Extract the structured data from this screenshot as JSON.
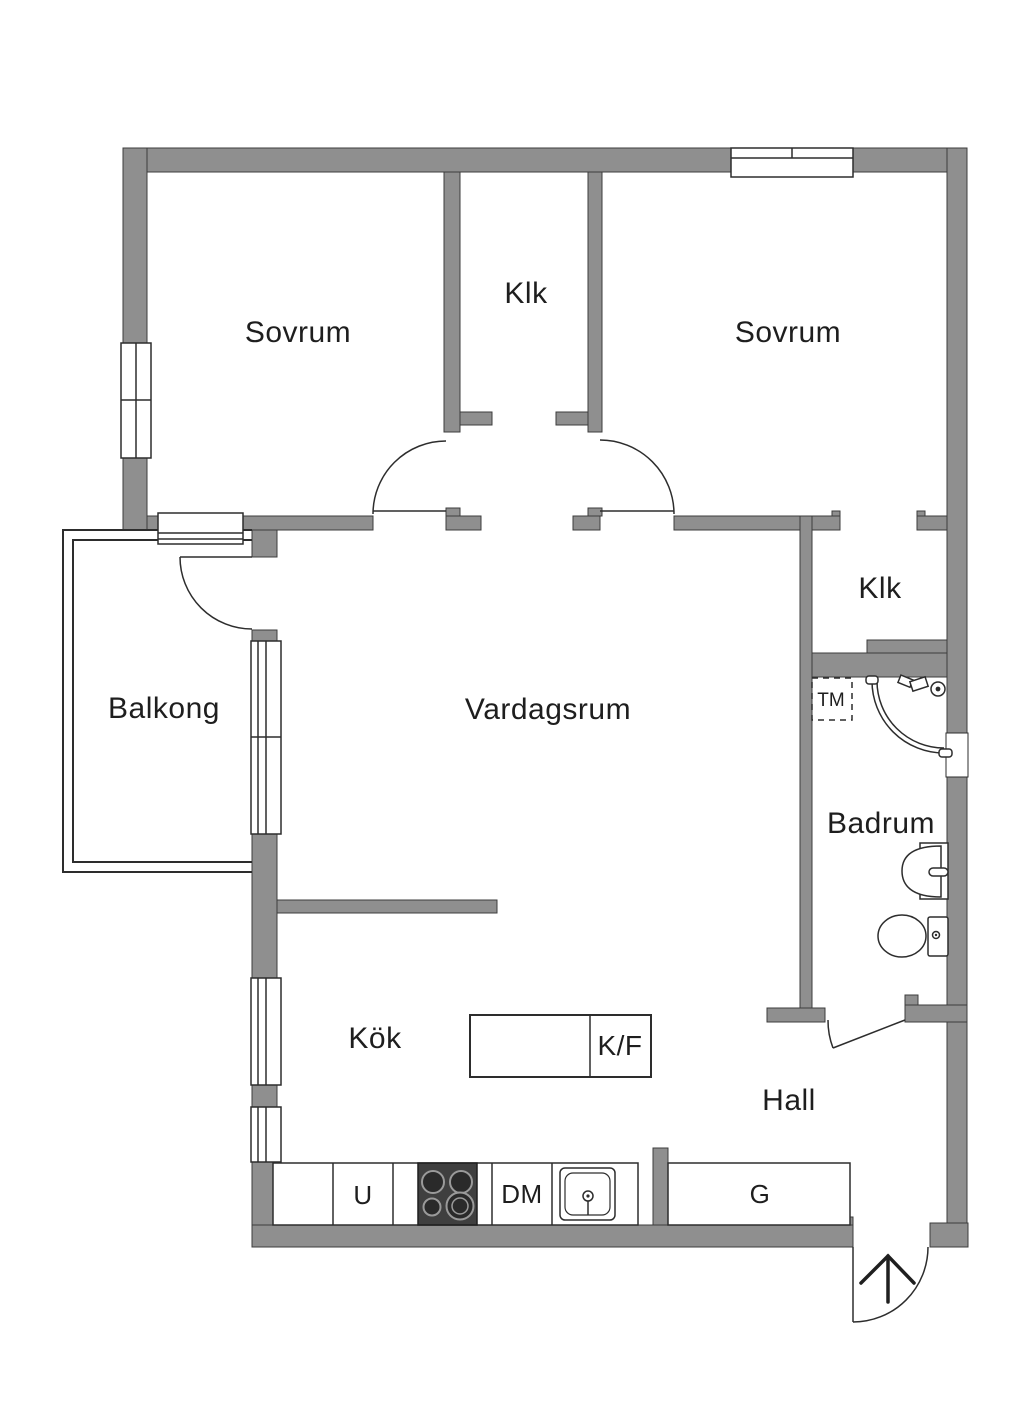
{
  "floorplan": {
    "rooms": {
      "bedroom_left": {
        "label": "Sovrum"
      },
      "closet_middle": {
        "label": "Klk"
      },
      "bedroom_right": {
        "label": "Sovrum"
      },
      "closet_right": {
        "label": "Klk"
      },
      "balcony": {
        "label": "Balkong"
      },
      "living_room": {
        "label": "Vardagsrum"
      },
      "bathroom": {
        "label": "Badrum"
      },
      "kitchen": {
        "label": "Kök"
      },
      "hall": {
        "label": "Hall"
      }
    },
    "fixtures": {
      "washing_machine": {
        "label": "TM"
      },
      "fridge_freezer": {
        "label": "K/F"
      },
      "oven": {
        "label": "U"
      },
      "dishwasher": {
        "label": "DM"
      },
      "wardrobe": {
        "label": "G"
      }
    },
    "colors": {
      "wall": "#8f8f8f",
      "wall_outline": "#3c3c3c",
      "line": "#2d2d2d",
      "text": "#1e1e1e",
      "background": "#ffffff",
      "stove": "#3f3f3f"
    }
  }
}
